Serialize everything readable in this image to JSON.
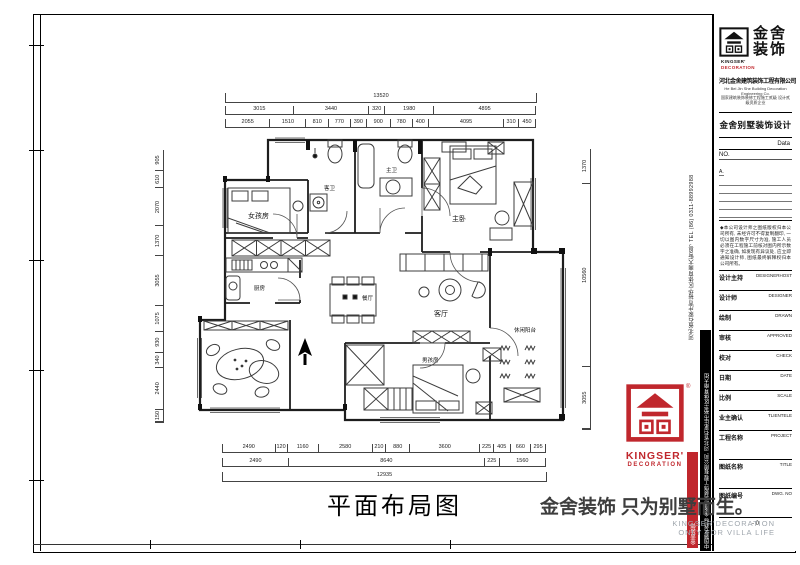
{
  "brand": {
    "logo_zh1": "金舍",
    "logo_zh2": "装饰",
    "logo_mark_sub1": "KINGSER'",
    "logo_mark_sub2": "DECORATION",
    "company_zh": "河北金舍建筑装饰工程有限公司",
    "company_en": "He Bei Jin She Building Decoration Engineering Co.",
    "credential": "国家建筑装饰装修工程施工贰级 设计贰级资质企业",
    "division": "金舍别墅装饰设计",
    "registered": "®",
    "red_hex": "#c0272d"
  },
  "titleblock": {
    "data_label": "Data",
    "no_label": "NO.",
    "revision_rows": [
      "A."
    ],
    "disclaimer": "◆本公司设计师之图纸版权归本公司所有, 未经许可不得复制翻印, 一切以图内数字尺寸为准, 施工人员必须在工程施工前核对图内所示数字之准确, 如发现有异议处, 应立即通知设计师, 图纸最终解释权归本公司所有。",
    "fields": [
      {
        "zh": "设计主持",
        "en": "DESIGNERHOST"
      },
      {
        "zh": "设计师",
        "en": "DESIGNER"
      },
      {
        "zh": "绘制",
        "en": "DRAWN"
      },
      {
        "zh": "审核",
        "en": "APPROVED"
      },
      {
        "zh": "校对",
        "en": "CHECK"
      },
      {
        "zh": "日期",
        "en": "DATE"
      },
      {
        "zh": "比例",
        "en": "SCALE"
      },
      {
        "zh": "业主确认",
        "en": "TLIENTELE"
      },
      {
        "zh": "工程名称",
        "en": "PROJECT"
      },
      {
        "zh": "图纸名称",
        "en": "TITLE"
      },
      {
        "zh": "图纸编号",
        "en": "DWG. NO"
      }
    ],
    "dwg_no_value": "- 0"
  },
  "strips": {
    "address_tel": "河北省石家庄市裕华区体育南大街6号  TEL (86) 0311-88992988",
    "cert_bar": "中国驰名商标 金舍建筑装饰工程有限公司, 河北省石家庄市裕华区体育南大街",
    "red_stripe": "金舍装饰"
  },
  "red_logo": {
    "name": "KINGSER'",
    "sub": "DECORATION"
  },
  "slogan": {
    "zh": "金舍装饰 只为别墅而生。",
    "en1": "KINGSER'DECORATION",
    "en2": "ONLY FOR VILLA LIFE"
  },
  "drawing": {
    "title": "平面布局图",
    "rooms": {
      "guest_bath": "客卫",
      "master_bath": "主卫",
      "master_bedroom": "主卧",
      "girl_room": "女孩房",
      "kitchen": "厨房",
      "dining": "餐厅",
      "living": "客厅",
      "leisure_balcony": "休闲阳台",
      "boy_room": "男孩房"
    },
    "dims": {
      "top_overall": "13520",
      "top_row2": [
        "3015",
        "3440",
        "320",
        "1980",
        "4895"
      ],
      "top_row3": [
        "2055",
        "1510",
        "810",
        "770",
        "390",
        "900",
        "780",
        "400",
        "4095",
        "310",
        "450"
      ],
      "bottom_row1": [
        "2490",
        "120",
        "1160",
        "2580",
        "210",
        "880",
        "3600",
        "225",
        "405",
        "660",
        "295"
      ],
      "bottom_row2": [
        "2490",
        "8640",
        "225",
        "1560"
      ],
      "bottom_overall": "12935",
      "left_chain": [
        "905",
        "610",
        "2070",
        "1370",
        "3055",
        "1075",
        "930",
        "340",
        "2440",
        "150"
      ],
      "right_chain": [
        "1370",
        "10560",
        "3055"
      ]
    }
  }
}
